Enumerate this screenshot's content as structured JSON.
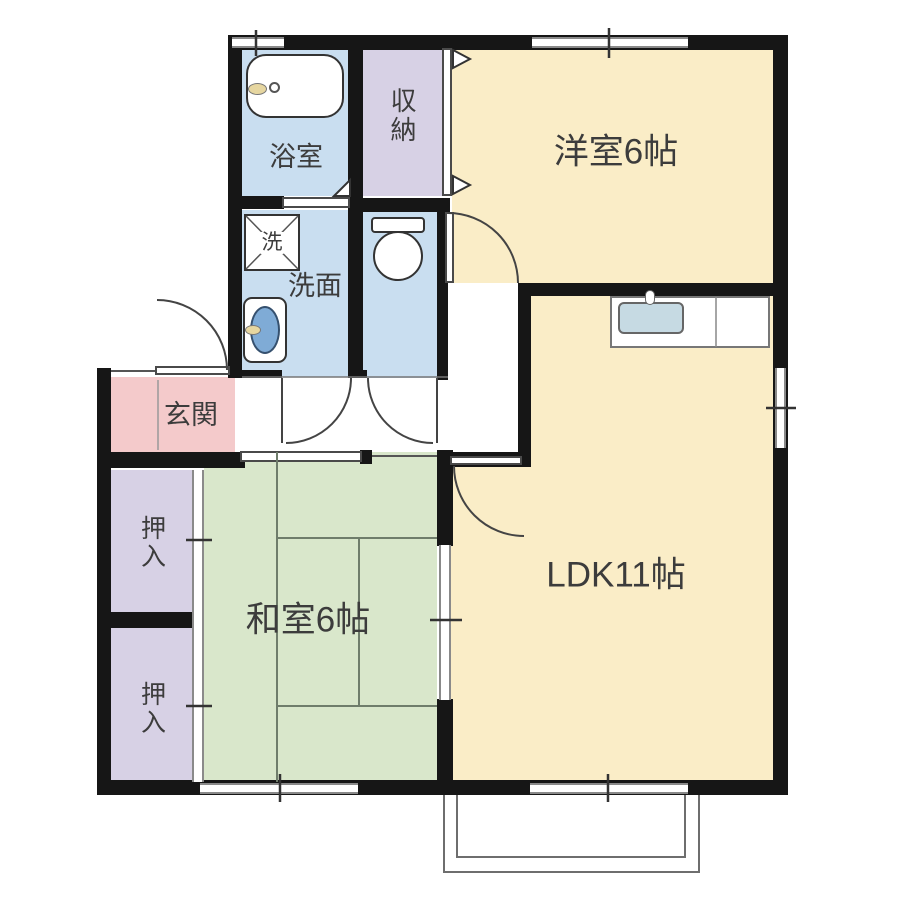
{
  "plan": {
    "rooms": {
      "western": {
        "label": "洋室6帖",
        "color": "#FAEDC7"
      },
      "ldk": {
        "label": "LDK11帖",
        "color": "#FAEDC7"
      },
      "japanese": {
        "label": "和室6帖",
        "color": "#D9E7CB"
      },
      "bath": {
        "label": "浴室",
        "color": "#C9DEF0"
      },
      "washroom": {
        "label": "洗面",
        "color": "#C9DEF0"
      },
      "toilet": {
        "color": "#C9DEF0"
      },
      "storage": {
        "label": "収納",
        "color": "#D7D1E5"
      },
      "closet_upper": {
        "label": "押入",
        "color": "#D7D1E5"
      },
      "closet_lower": {
        "label": "押入",
        "color": "#D7D1E5"
      },
      "entrance": {
        "label": "玄関",
        "color": "#F4CACB"
      }
    },
    "fixtures": {
      "washer_label": "洗"
    },
    "wall_color": "#161616",
    "tatami_line_color": "#6f7d6b",
    "sink_bowl_color": "#7FABD6",
    "kitchen_sink_color": "#C6DAE3"
  }
}
